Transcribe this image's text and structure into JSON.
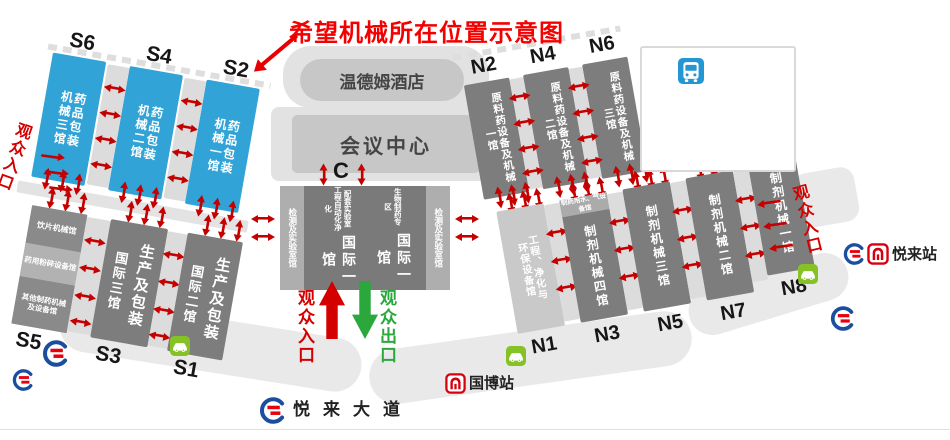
{
  "title": "希望机械所在位置示意图",
  "colors": {
    "hall_blue": "#31a3d7",
    "hall_dark": "#7d7d7d",
    "hall_medium": "#aeaeae",
    "hall_light": "#c9c9c9",
    "aisle": "#dcdcdc",
    "ground": "#e9e9e9",
    "arrow_red": "#c40000",
    "entrance_red": "#d40000",
    "exit_green": "#2aa83c",
    "title_red": "#f40000",
    "metro_blue": "#1c4ea0",
    "metro_red": "#e8000d",
    "parking_green": "#86c226",
    "bus_blue": "#2496d3"
  },
  "halls": {
    "S6": {
      "code": "S6",
      "name": "药品包装\n机械三馆"
    },
    "S4": {
      "code": "S4",
      "name": "药品包装\n机械二馆"
    },
    "S2": {
      "code": "S2",
      "name": "药品包装\n机械一馆"
    },
    "S5": {
      "code": "S5",
      "sections": [
        "饮片机械馆",
        "药用粉碎设备馆",
        "其他制药机械\n及设备馆"
      ]
    },
    "S3": {
      "code": "S3",
      "main": "生产及包装",
      "sub": "国际三馆"
    },
    "S1": {
      "code": "S1",
      "main": "生产及包装",
      "sub": "国际二馆"
    },
    "N2": {
      "code": "N2",
      "name": "原料药设备及机械\n一馆"
    },
    "N4": {
      "code": "N4",
      "name": "原料药设备及机械\n二馆"
    },
    "N6": {
      "code": "N6",
      "name": "原料药设备及机械\n三馆"
    },
    "N1": {
      "code": "N1",
      "name": "工程、净化与\n环保设备馆"
    },
    "N3": {
      "code": "N3",
      "header": "制药用水、气设备馆",
      "name": "制剂机械四馆"
    },
    "N5": {
      "code": "N5",
      "name": "制剂机械三馆"
    },
    "N7": {
      "code": "N7",
      "name": "制剂机械二馆"
    },
    "N8": {
      "code": "N8",
      "name": "制剂机械一馆"
    },
    "C": {
      "code": "C",
      "lab_left": "检测及实验室馆",
      "lab_right": "检测及实验室馆",
      "block_a_sub": "配套实验室\n工程自动化净化",
      "block_a_main": "国际一馆",
      "block_b_sub": "生物制药专区",
      "block_b_main": "国际一馆"
    }
  },
  "buildings": {
    "hotel": "温德姆酒店",
    "conference": "会议中心"
  },
  "entrances": {
    "west": "观众入口",
    "east": "观众入口",
    "south_in": "观众入口",
    "south_out": "观众出口"
  },
  "transit": {
    "yuelai_station": "悦来站",
    "guobo_station": "国博站",
    "yuelai_avenue": "悦来大道"
  },
  "icons": {
    "metro_logo": "chongqing-rail-transit-logo",
    "metro_station": "metro-station-icon",
    "bus_stop": "bus-stop-icon",
    "parking": "parking-car-icon",
    "double_arrow": "red-double-arrow-icon",
    "entrance_arrow": "red-up-block-arrow",
    "exit_arrow": "green-down-block-arrow"
  }
}
